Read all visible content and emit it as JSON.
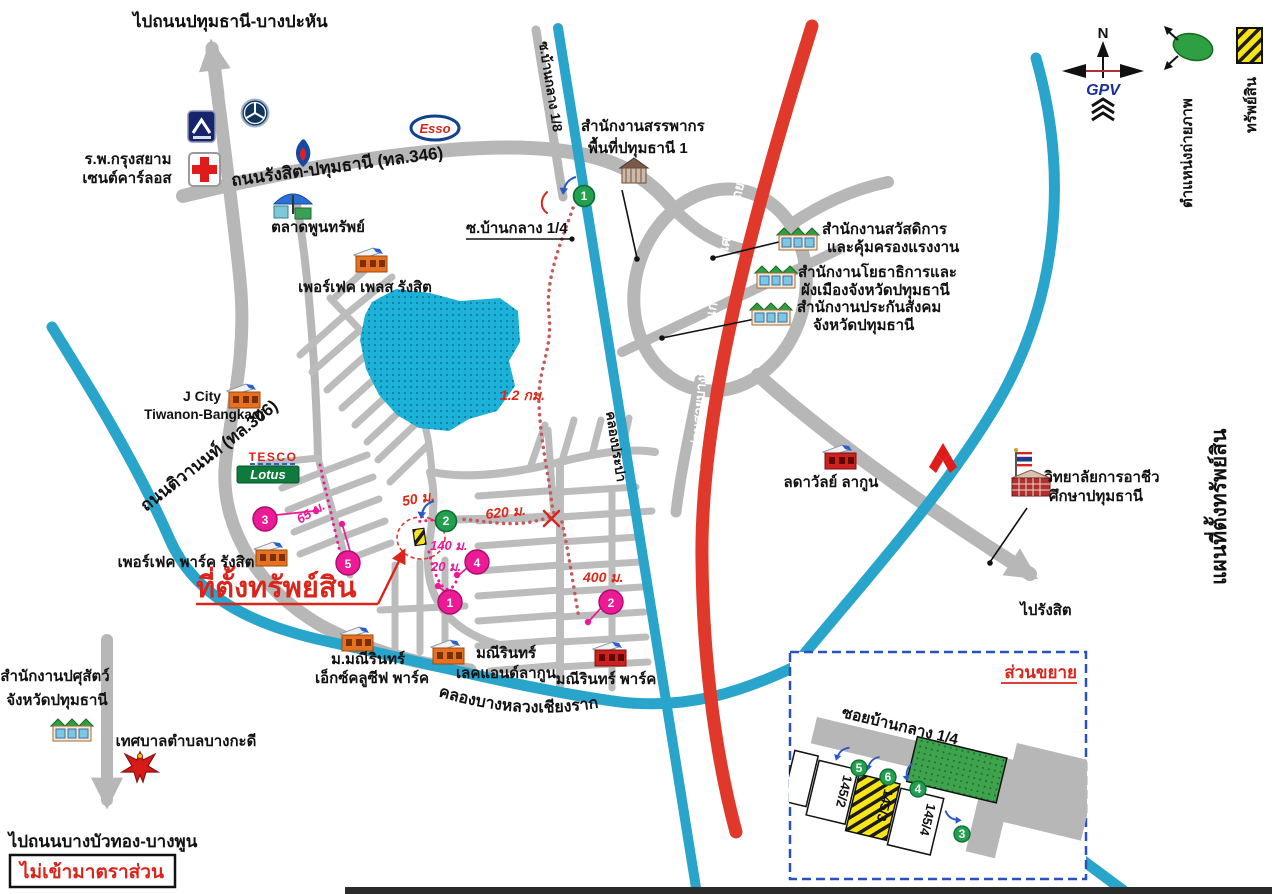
{
  "title_vertical": "แผนที่ตั้งทรัพย์สิน",
  "scale_note": "ไม่เข้ามาตราส่วน",
  "compass": {
    "north": "N",
    "logo": "GPV"
  },
  "legend": {
    "photo_position_label": "ตำแหน่งถ่ายภาพ",
    "property_label": "ทรัพย์สิน"
  },
  "roads": {
    "hwy346": "ถนนรังสิต-ปทุมธานี (ทล.346)",
    "hwy306": "ถนนติวานนท์ (ทล.306)",
    "soi_banklang_1_8": "ซ.บ้านกลาง 1/8",
    "soi_banklang_1_4": "ซ.บ้านกลาง 1/4",
    "expressway": "ทางด่วนสายบางปะอิน-ปากเกร็ด-ทางพิเศษอุดรรัถยา",
    "to_north": "ไปถนนปทุมธานี-บางปะหัน",
    "to_rangsit": "ไปรังสิต",
    "to_south": "ไปถนนบางบัวทอง-บางพูน"
  },
  "canals": {
    "prapa": "คลองประปา",
    "bangluang": "คลองบางหลวงเชียงราก"
  },
  "property": {
    "callout": "ที่ตั้งทรัพย์สิน"
  },
  "distances": {
    "km12": "1.2 กม.",
    "m620": "620 ม.",
    "m50": "50 ม.",
    "m140": "140 ม.",
    "m20": "20 ม.",
    "m400": "400 ม.",
    "m65": "65 ม."
  },
  "markers": {
    "green": [
      "1",
      "2"
    ],
    "pink": [
      "1",
      "2",
      "3",
      "4",
      "5"
    ]
  },
  "landmarks": {
    "hospital": {
      "line1": "ร.พ.กรุงสยาม",
      "line2": "เซนต์คาร์ลอส"
    },
    "market": "ตลาดพูนทรัพย์",
    "esso": "Esso",
    "revenue": {
      "line1": "สำนักงานสรรพากร",
      "line2": "พื้นที่ปทุมธานี 1"
    },
    "welfare": {
      "line1": "สำนักงานสวัสดิการ",
      "line2": "และคุ้มครองแรงงาน"
    },
    "publicworks": {
      "line1": "สำนักงานโยธาธิการและ",
      "line2": "ผังเมืองจังหวัดปทุมธานี"
    },
    "socialsecurity": {
      "line1": "สำนักงานประกันสังคม",
      "line2": "จังหวัดปทุมธานี"
    },
    "perfect_place": "เพอร์เฟค เพลส รังสิต",
    "jcity": {
      "line1": "J City",
      "line2": "Tiwanon-Bangkadi"
    },
    "tesco": {
      "line1": "TESCO",
      "line2": "Lotus"
    },
    "perfect_park": "เพอร์เฟค พาร์ค รังสิต",
    "maneerin_exclusive": {
      "line1": "ม.มณีรินทร์",
      "line2": "เอ็กซ์คลูซีฟ พาร์ค"
    },
    "maneerin_lake": {
      "line1": "มณีรินทร์",
      "line2": "เลคแอนด์ลากูน"
    },
    "maneerin_park": "มณีรินทร์ พาร์ค",
    "ladawan": "ลดาวัลย์ ลากูน",
    "college": {
      "line1": "วิทยาลัยการอาชีว",
      "line2": "ศึกษาปทุมธานี"
    },
    "livestock": {
      "line1": "สำนักงานปศุสัตว์",
      "line2": "จังหวัดปทุมธานี"
    },
    "municipality": "เทศบาลตำบลบางกะดี"
  },
  "inset": {
    "title": "ส่วนขยาย",
    "road": "ซอยบ้านกลาง 1/4",
    "parcels": [
      "145/2",
      "145/3",
      "145/4"
    ],
    "photo_markers": [
      "3",
      "4",
      "5",
      "6"
    ]
  },
  "colors": {
    "road_gray": "#b7b7b7",
    "water_teal": "#29a5cc",
    "expressway_red": "#e0392b",
    "lake_cyan": "#1cb2d8",
    "route_dot": "#c25b5b",
    "pink": "#ec1a96",
    "green_marker": "#22a04f",
    "property_yellow": "#f9e516",
    "accent_red": "#d9251c"
  }
}
